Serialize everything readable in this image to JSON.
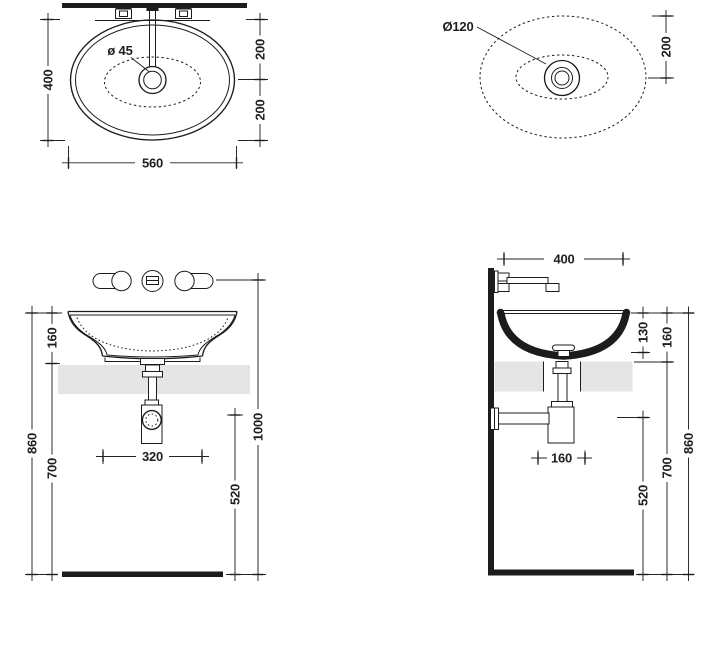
{
  "drawing": {
    "title": "Washbasin installation drawing",
    "colors": {
      "line": "#1c1c1c",
      "dimension": "#232323",
      "countertop": "#e5e5e5",
      "background": "#ffffff"
    },
    "views": {
      "plan": {
        "name": "Top view with faucet",
        "dims": {
          "depth": "400",
          "width": "560",
          "drain_to_wall": "200",
          "drain_to_front": "200",
          "drain_hole": "ø 45"
        }
      },
      "plan_drain": {
        "name": "Top view drain detail",
        "dims": {
          "drain_flange": "Ø120",
          "drain_to_wall": "200"
        }
      },
      "front": {
        "name": "Front elevation",
        "dims": {
          "rim_above_counter": "160",
          "rim_to_floor": "860",
          "counter_to_floor": "700",
          "tap_spacing": "320",
          "outlet_height": "520",
          "faucet_height": "1000"
        }
      },
      "side": {
        "name": "Side elevation",
        "dims": {
          "spout_reach": "400",
          "bowl_depth": "130",
          "rim_above_counter": "160",
          "rim_to_floor": "860",
          "counter_to_floor": "700",
          "outlet_height": "520",
          "outlet_to_wall": "160"
        }
      }
    }
  }
}
